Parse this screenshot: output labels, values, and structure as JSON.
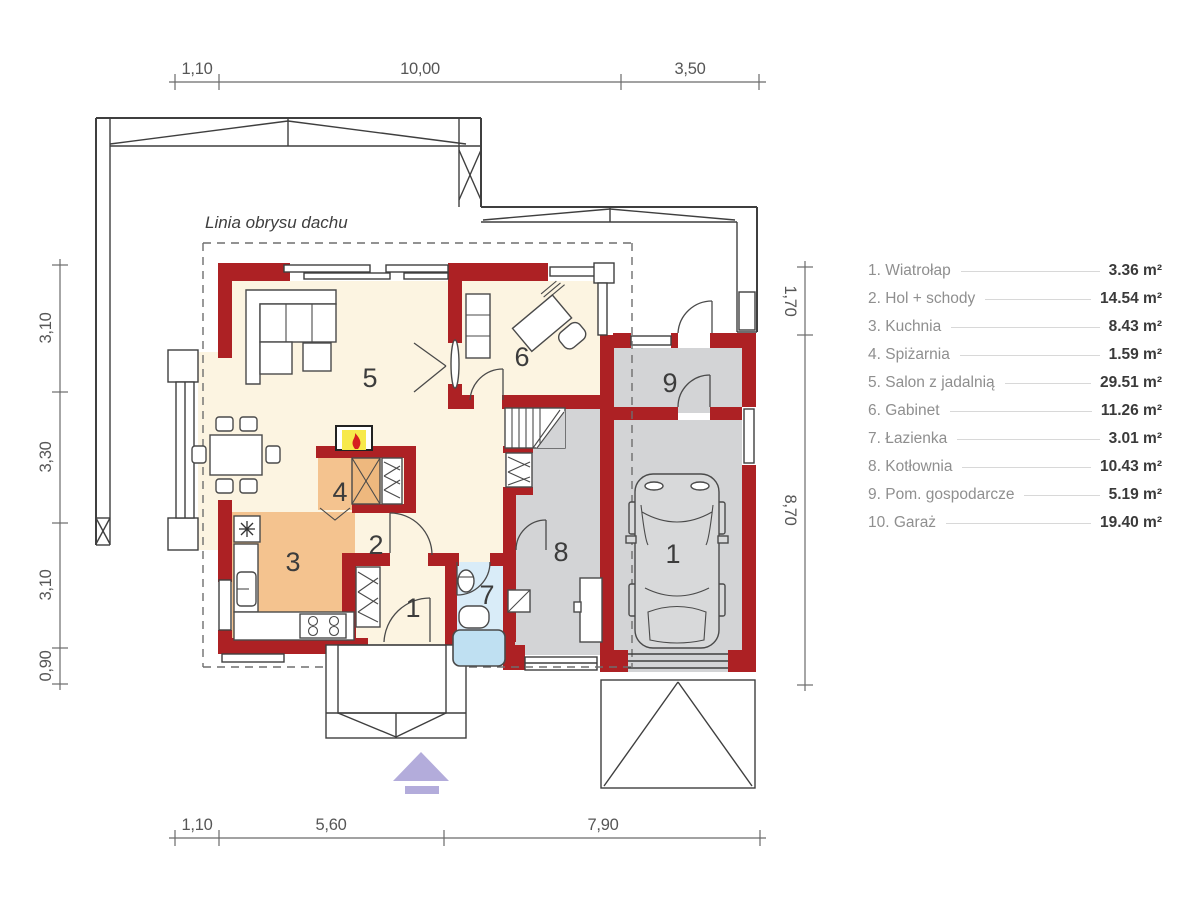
{
  "plan_note": "Linia obrysu dachu",
  "dimensions": {
    "top": [
      "1,10",
      "10,00",
      "3,50"
    ],
    "bottom": [
      "1,10",
      "5,60",
      "7,90"
    ],
    "left": [
      "3,10",
      "3,30",
      "3,10",
      "0,90"
    ],
    "right": [
      "1,70",
      "8,70"
    ]
  },
  "rooms": [
    {
      "name": "1. Wiatrołap",
      "area": "3.36 m²",
      "plan_label": "1"
    },
    {
      "name": "2. Hol + schody",
      "area": "14.54 m²",
      "plan_label": "2"
    },
    {
      "name": "3. Kuchnia",
      "area": "8.43 m²",
      "plan_label": "3"
    },
    {
      "name": "4. Spiżarnia",
      "area": "1.59 m²",
      "plan_label": "4"
    },
    {
      "name": "5. Salon z jadalnią",
      "area": "29.51 m²",
      "plan_label": "5"
    },
    {
      "name": "6. Gabinet",
      "area": "11.26 m²",
      "plan_label": "6"
    },
    {
      "name": "7. Łazienka",
      "area": "3.01 m²",
      "plan_label": "7"
    },
    {
      "name": "8. Kotłownia",
      "area": "10.43 m²",
      "plan_label": "8"
    },
    {
      "name": "9. Pom. gospodarcze",
      "area": "5.19 m²",
      "plan_label": "9"
    },
    {
      "name": "10. Garaż",
      "area": "19.40 m²",
      "plan_label": "1"
    }
  ],
  "colors": {
    "wall": "#ad2124",
    "floor_cream": "#fcf4e1",
    "floor_orange": "#f4c38f",
    "floor_gray": "#d3d4d6",
    "floor_blue": "#d9ecf8",
    "entrance_arrow": "#b3acdb",
    "flame_yellow": "#f7e94b",
    "flame_red": "#d61f1f"
  }
}
